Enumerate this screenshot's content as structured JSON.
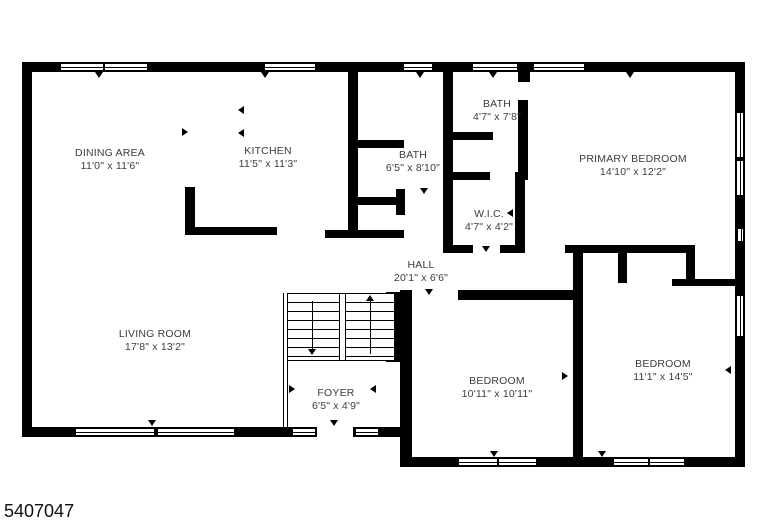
{
  "page": {
    "type": "floor-plan",
    "background": "#ffffff",
    "photo_id": "5407047"
  },
  "colors": {
    "wall": "#000000",
    "label_text": "#3c3c3c"
  },
  "symbols": {
    "wall": "solid-black-bar",
    "window": "double-line-window",
    "door_marker": "small-triangle-tick",
    "stair_up_arrow": "up",
    "stair_down_arrow": "down"
  },
  "rooms": [
    {
      "name": "DINING AREA",
      "dims": "11'0\" x 11'6\""
    },
    {
      "name": "KITCHEN",
      "dims": "11'5\" x 11'3\""
    },
    {
      "name": "BATH",
      "dims": "6'5\" x 8'10\""
    },
    {
      "name": "BATH",
      "dims": "4'7\" x 7'8\""
    },
    {
      "name": "PRIMARY BEDROOM",
      "dims": "14'10\" x 12'2\""
    },
    {
      "name": "W.I.C.",
      "dims": "4'7\" x 4'2\""
    },
    {
      "name": "HALL",
      "dims": "20'1\" x 6'6\""
    },
    {
      "name": "LIVING ROOM",
      "dims": "17'8\" x 13'2\""
    },
    {
      "name": "FOYER",
      "dims": "6'5\" x 4'9\""
    },
    {
      "name": "BEDROOM",
      "dims": "10'11\" x 10'11\""
    },
    {
      "name": "BEDROOM",
      "dims": "11'1\" x 14'5\""
    }
  ]
}
